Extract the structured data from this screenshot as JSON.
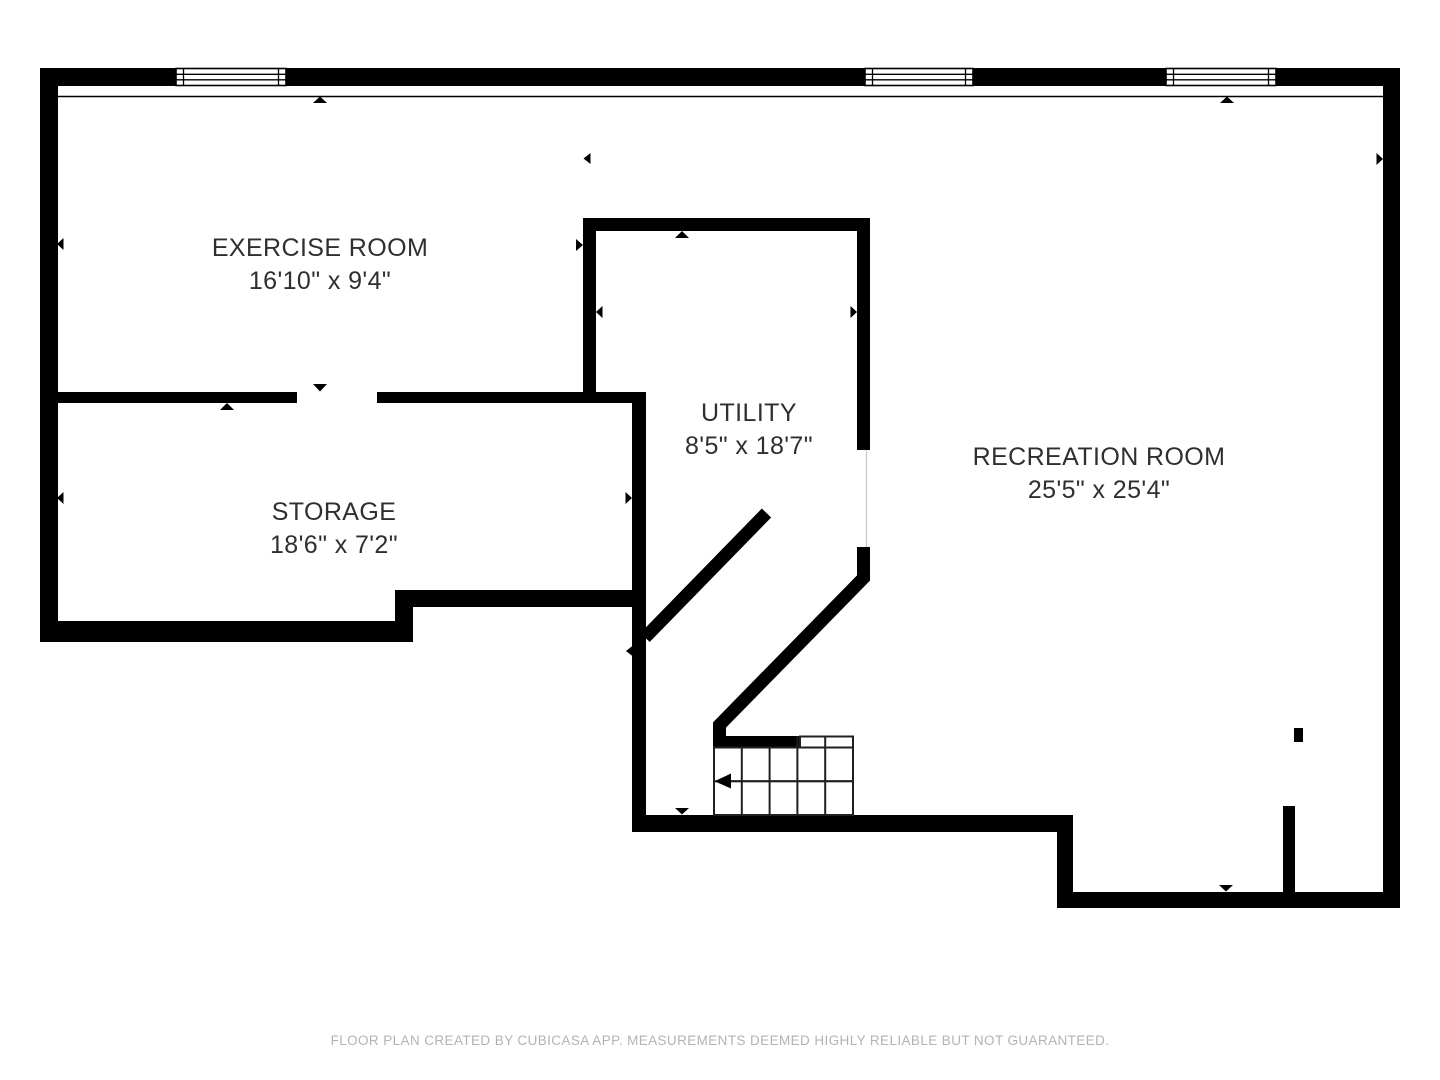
{
  "plan": {
    "background": "#ffffff",
    "wall_color": "#000000",
    "label_color": "#2f2f2f",
    "rooms": [
      {
        "id": "exercise-room",
        "name": "EXERCISE ROOM",
        "dimensions": "16'10\" x 9'4\""
      },
      {
        "id": "storage",
        "name": "STORAGE",
        "dimensions": "18'6\" x 7'2\""
      },
      {
        "id": "utility",
        "name": "UTILITY",
        "dimensions": "8'5\" x 18'7\""
      },
      {
        "id": "recreation-room",
        "name": "RECREATION ROOM",
        "dimensions": "25'5\" x 25'4\""
      }
    ]
  },
  "footer": {
    "disclaimer": "FLOOR PLAN CREATED BY CUBICASA APP. MEASUREMENTS DEEMED HIGHLY RELIABLE BUT NOT GUARANTEED."
  }
}
